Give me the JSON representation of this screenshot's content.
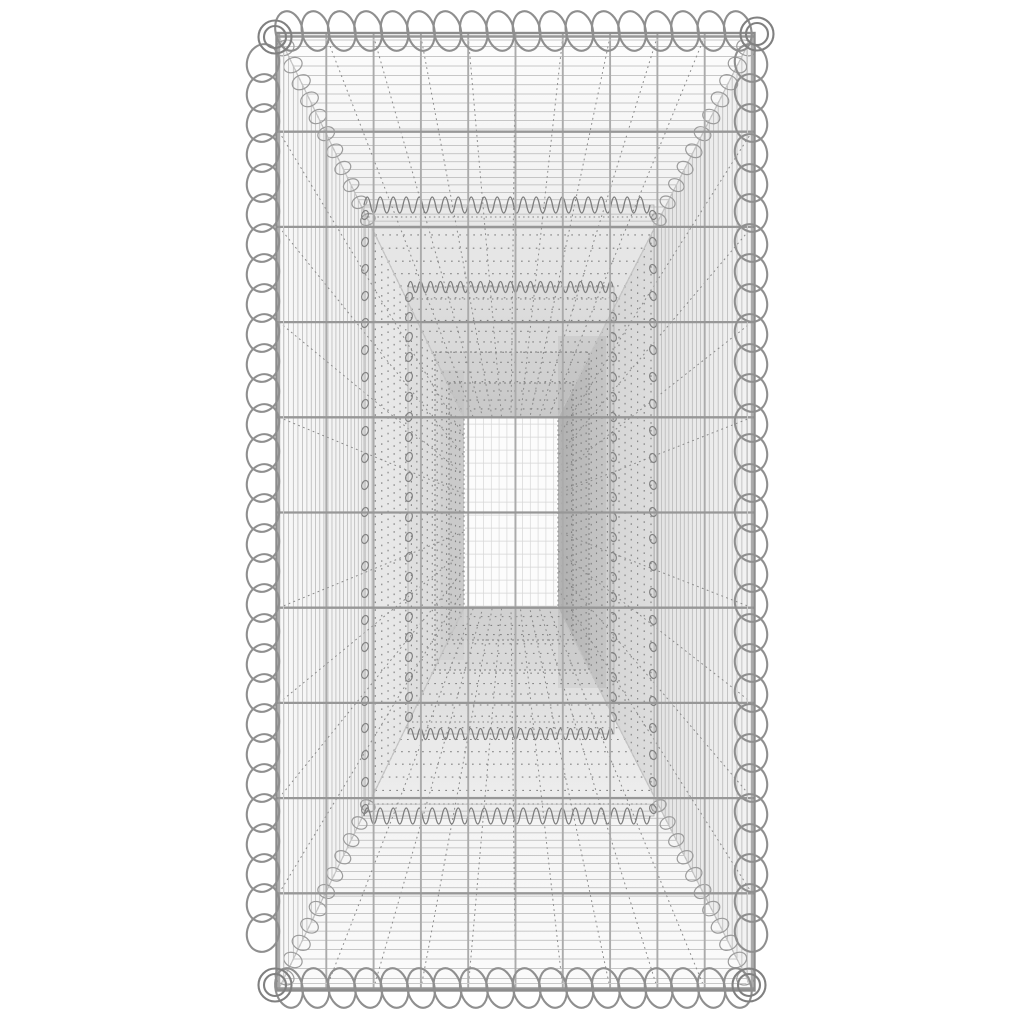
{
  "page": {
    "bg": "#ffffff"
  },
  "product_image": {
    "alt": "Galvanised steel gabion basket viewed through its open end: spiral wire bindings along every edge, welded mesh walls receding in perspective to a small bright far-end mesh panel",
    "canvas": {
      "w": 1024,
      "h": 1024
    },
    "outer": {
      "l": 279,
      "r": 752,
      "t": 36.5,
      "b": 988.5
    },
    "frame_edge": {
      "l": 276.5,
      "r": 754.5,
      "t": 33,
      "b": 990.5
    },
    "window": {
      "l": 464,
      "r": 558,
      "t": 417.6,
      "b": 608
    },
    "mesh": {
      "cols": 11,
      "rows": 11
    },
    "projection": {
      "a": 0.65,
      "steps": 58,
      "solid_limit": 0.52
    },
    "inner_frames": [
      {
        "style": "coil",
        "l": 364,
        "r": 654,
        "t": 205,
        "b": 816,
        "coil_step": 27,
        "zig_period": 13,
        "zig_amp": 8
      },
      {
        "style": "coil",
        "l": 408,
        "r": 614,
        "t": 287,
        "b": 734,
        "coil_step": 20,
        "zig_period": 10,
        "zig_amp": 5.5
      },
      {
        "style": "dotted",
        "l": 435,
        "r": 589,
        "t": 352,
        "b": 670
      },
      {
        "style": "dotted",
        "l": 449,
        "r": 573,
        "t": 383,
        "b": 640
      }
    ],
    "window_grid": {
      "vstep": 7.8,
      "hstep": 13
    },
    "spirals": {
      "top": {
        "axis": "h",
        "y": 31,
        "x0": 289,
        "x1": 741,
        "step": 26.4,
        "rx": 13.5,
        "ry": 20,
        "rot": -12
      },
      "bottom": {
        "axis": "h",
        "y": 988,
        "x0": 289,
        "x1": 741,
        "step": 26.4,
        "rx": 13.5,
        "ry": 20,
        "rot": -12
      },
      "left": {
        "axis": "v",
        "x": 263,
        "y0": 63,
        "y1": 942,
        "step": 30,
        "rx": 16,
        "ry": 19,
        "rot": 14
      },
      "right": {
        "axis": "v",
        "x": 751,
        "y0": 63,
        "y1": 942,
        "step": 30,
        "rx": 16,
        "ry": 19,
        "rot": -14
      }
    },
    "corner_rings": [
      {
        "x": 275,
        "y": 37
      },
      {
        "x": 757,
        "y": 34
      },
      {
        "x": 275,
        "y": 985
      },
      {
        "x": 749,
        "y": 985
      }
    ],
    "ring_radii": [
      16.5,
      11
    ],
    "seam_loops": {
      "u_start": 0.03,
      "u_end": 0.5,
      "u_step": 0.045
    },
    "colors": {
      "bg": "#ffffff",
      "wall_left": [
        "#f8f8f8",
        "#e8e8e8"
      ],
      "wall_right": [
        "#f3f3f3",
        "#d3d3d3"
      ],
      "wall_top": [
        "#fdfdfd",
        "#e1e1e1"
      ],
      "wall_bottom": [
        "#fbfbfb",
        "#ebebeb"
      ],
      "shade": "rgba(70,70,70,0.035)",
      "shade_right": "rgba(60,60,60,0.07)",
      "window_fill": "#fcfcfc",
      "window_grid": "#d6d6d6",
      "window_dots": "#909090",
      "texture": "#b6b6b6",
      "dot_col": "#7f7f7f",
      "fan": "#8a8a8a",
      "seam": "#c4c4c4",
      "seam_loop": "#9b9b9b",
      "wire_h": "#979797",
      "wire_v": "#ababab",
      "frame_wire": "#8c8c8c",
      "frame_wire2": "#c8c8c8",
      "frame_line": "#b2b2b2",
      "coil": "#828282",
      "zig": "#7d7d7d",
      "spiral": "#8f8f8f",
      "ring": "#808080"
    }
  }
}
